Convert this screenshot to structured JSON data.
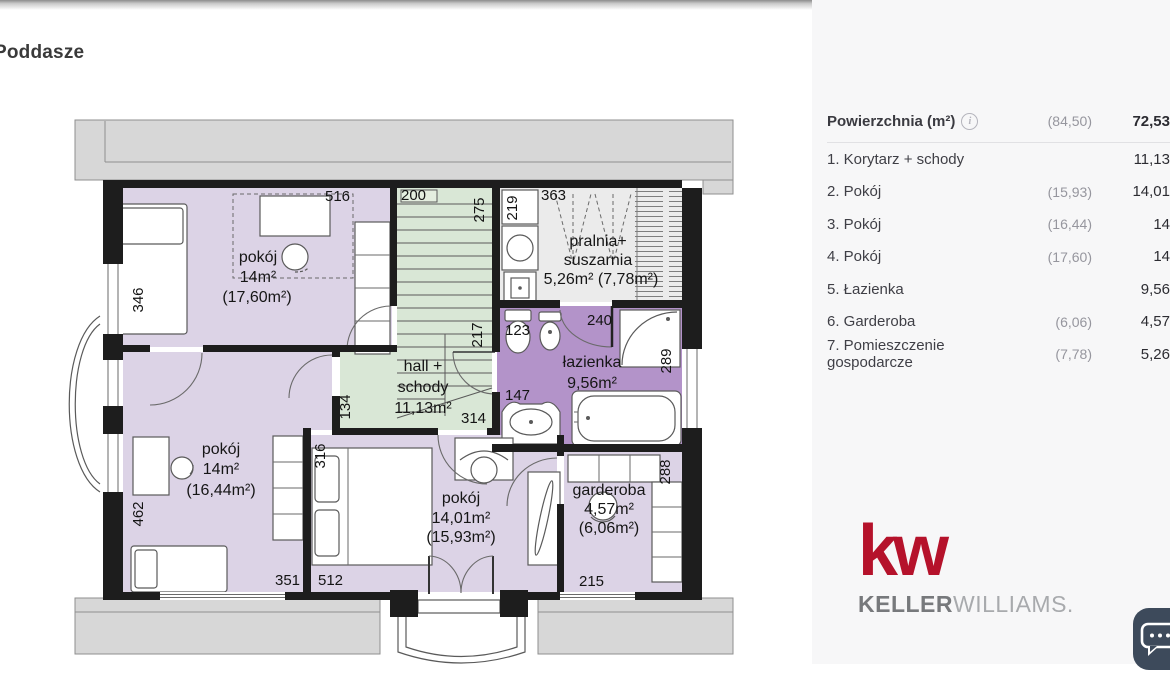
{
  "title": "Poddasze",
  "panel": {
    "header": {
      "label": "Powierzchnia (m²)",
      "projected": "(84,50)",
      "total": "72,53"
    },
    "rows": [
      {
        "name": "1. Korytarz + schody",
        "projected": "",
        "area": "11,13"
      },
      {
        "name": "2. Pokój",
        "projected": "(15,93)",
        "area": "14,01"
      },
      {
        "name": "3. Pokój",
        "projected": "(16,44)",
        "area": "14"
      },
      {
        "name": "4. Pokój",
        "projected": "(17,60)",
        "area": "14"
      },
      {
        "name": "5. Łazienka",
        "projected": "",
        "area": "9,56"
      },
      {
        "name": "6. Garderoba",
        "projected": "(6,06)",
        "area": "4,57"
      },
      {
        "name": "7. Pomieszczenie gospodarcze",
        "projected": "(7,78)",
        "area": "5,26"
      }
    ]
  },
  "plan": {
    "rooms": {
      "pokoj_top": {
        "name": "pokój",
        "area": "14m²",
        "projected": "(17,60m²)"
      },
      "hall": {
        "line1": "hall +",
        "line2": "schody",
        "area": "11,13m²"
      },
      "pralnia": {
        "line1": "pralnia+",
        "line2": "suszarnia",
        "area": "5,26m² (7,78m²)"
      },
      "lazienka": {
        "name": "łazienka",
        "area": "9,56m²"
      },
      "pokoj_left": {
        "name": "pokój",
        "area": "14m²",
        "projected": "(16,44m²)"
      },
      "pokoj_center": {
        "name": "pokój",
        "area": "14,01m²",
        "projected": "(15,93m²)"
      },
      "garderoba": {
        "name": "garderoba",
        "area": "4,57m²",
        "projected": "(6,06m²)"
      }
    },
    "dims": {
      "d516": "516",
      "d200": "200",
      "d275": "275",
      "d363": "363",
      "d219": "219",
      "d346": "346",
      "d217": "217",
      "d123": "123",
      "d240": "240",
      "d289": "289",
      "d147": "147",
      "d314": "314",
      "d134": "134",
      "d316": "316",
      "d462": "462",
      "d351": "351",
      "d512": "512",
      "d215": "215",
      "d288": "288"
    }
  },
  "logo": {
    "mark": "kw",
    "brand_primary": "KELLER",
    "brand_secondary": "WILLIAMS."
  },
  "icons": {
    "info": "i"
  },
  "colors": {
    "kw_red": "#b5122b",
    "room_lavender": "#dcd3e6",
    "bathroom_purple": "#b393c9",
    "hall_green": "#d9e7d6",
    "utility_gray": "#ebebeb",
    "wall_black": "#1d1d1d",
    "panel_bg": "#f7f7f8",
    "chat_bg": "#3d4a5b"
  }
}
